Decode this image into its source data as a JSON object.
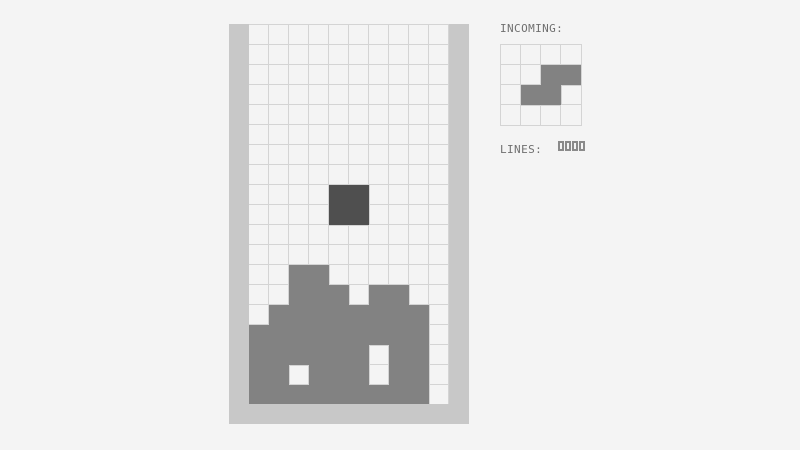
{
  "colors": {
    "background": "#f4f4f4",
    "wall": "#c8c8c8",
    "grid_line": "#d4d4d4",
    "empty_cell": "#f4f4f4",
    "stack": "#828282",
    "falling_piece": "#4f4f4f",
    "label_text": "#6f6f6f",
    "lines_digit": "#8a8a8a"
  },
  "board": {
    "cols": 10,
    "rows": 19,
    "cell_size": 20,
    "cells": [
      "..........",
      "..........",
      "..........",
      "..........",
      "..........",
      "..........",
      "..........",
      "..........",
      "....OO....",
      "....OO....",
      "..........",
      "..........",
      "..XX......",
      "..XXX.XX..",
      ".XXXXXXXX.",
      "XXXXXXXXX.",
      "XXXXXX.XX.",
      "XX.XXX.XX.",
      "XXXXXXXXX."
    ]
  },
  "sidebar": {
    "incoming_label": "INCOMING:",
    "preview": {
      "cols": 4,
      "rows": 4,
      "cells": [
        "....",
        "..XX",
        ".XX.",
        "...."
      ],
      "piece_name": "s-piece"
    },
    "lines_label": "LINES:",
    "lines_value": "0000"
  }
}
